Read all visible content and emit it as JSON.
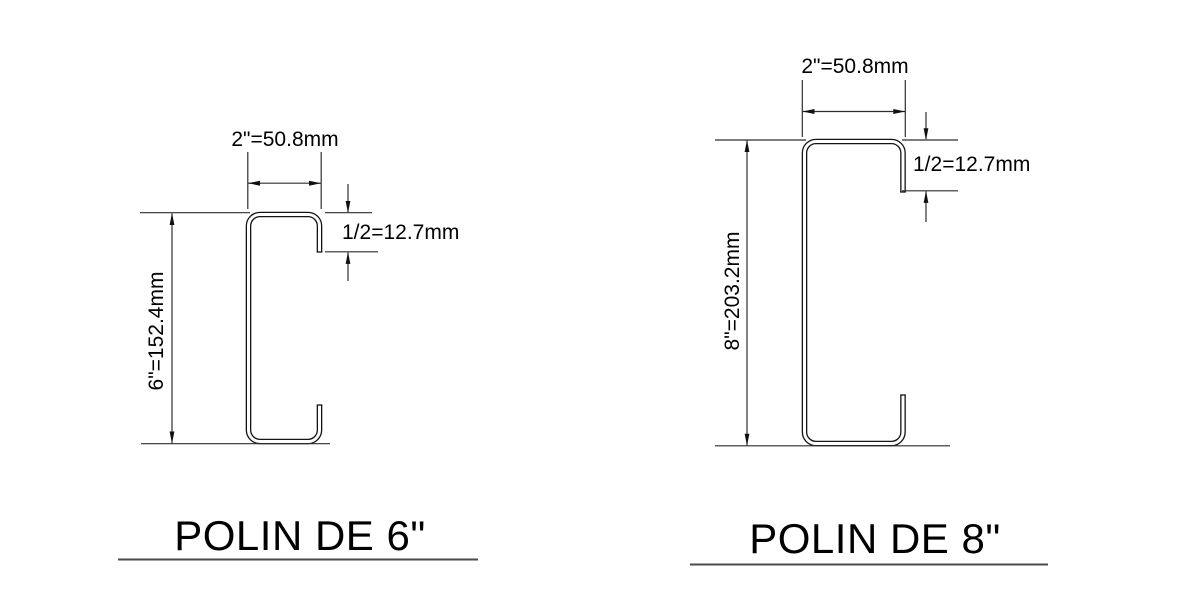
{
  "drawing": {
    "background": "#ffffff",
    "colors": {
      "profile_line": "#141414",
      "dimension_line": "#2e2e2e",
      "arrow_fill": "#111111",
      "text": "#000000",
      "underline": "#4a4a4a"
    },
    "figures": [
      {
        "title": "POLIN DE 6\"",
        "width_label": "2\"=50.8mm",
        "height_label": "6\"=152.4mm",
        "lip_label": "1/2=12.7mm"
      },
      {
        "title": "POLIN DE 8\"",
        "width_label": "2\"=50.8mm",
        "height_label": "8\"=203.2mm",
        "lip_label": "1/2=12.7mm"
      }
    ]
  }
}
